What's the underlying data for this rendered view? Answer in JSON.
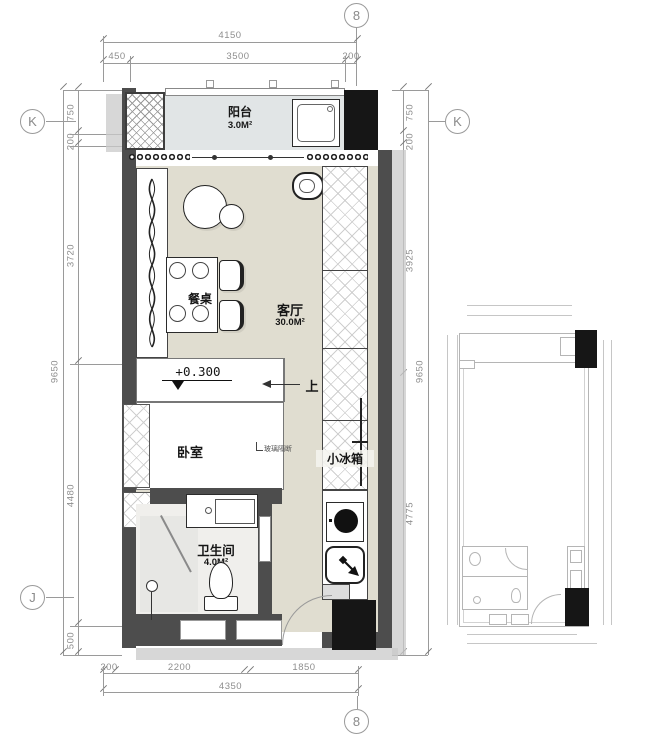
{
  "title": "apartment-floor-plan",
  "grid": {
    "top_axis": "8",
    "bottom_axis": "8",
    "left_axis_top": "K",
    "left_axis_bottom": "J",
    "right_axis_top": "K"
  },
  "dims": {
    "top": {
      "overall": "4150",
      "seg1": "450",
      "seg2": "3500",
      "seg3": "200"
    },
    "left": {
      "overall": "9650",
      "seg1": "750",
      "seg2": "200",
      "seg3": "3720",
      "seg4": "4480",
      "seg5": "500"
    },
    "right": {
      "overall": "9650",
      "seg1": "750",
      "seg2": "200",
      "seg3": "3925",
      "seg4": "4775"
    },
    "bottom": {
      "overall": "4350",
      "seg1": "200",
      "seg2": "2200",
      "seg3": "1850"
    }
  },
  "labels": {
    "balcony": "阳台",
    "balcony_area": "3.0M²",
    "living": "客厅",
    "living_area": "30.0M²",
    "dining_table": "餐桌",
    "bedroom": "卧室",
    "bathroom": "卫生间",
    "bathroom_area": "4.0M²",
    "fridge": "小冰箱",
    "level": "+0.300",
    "up": "上",
    "glass_partition": "玻璃隔断"
  },
  "colors": {
    "wall": "#4d4d4d",
    "column": "#161616",
    "floor": "#e0ddd0",
    "balcony_floor": "#e1e5e6",
    "bath_floor": "#f0efec",
    "shower_floor": "#e7e7e4",
    "dim_text": "#8e8e8e",
    "dim_line": "#9a9a9a",
    "shadow": "#c9c9c9",
    "stroke": "#2b2b2b",
    "mini_stroke": "#b5b5b5"
  }
}
